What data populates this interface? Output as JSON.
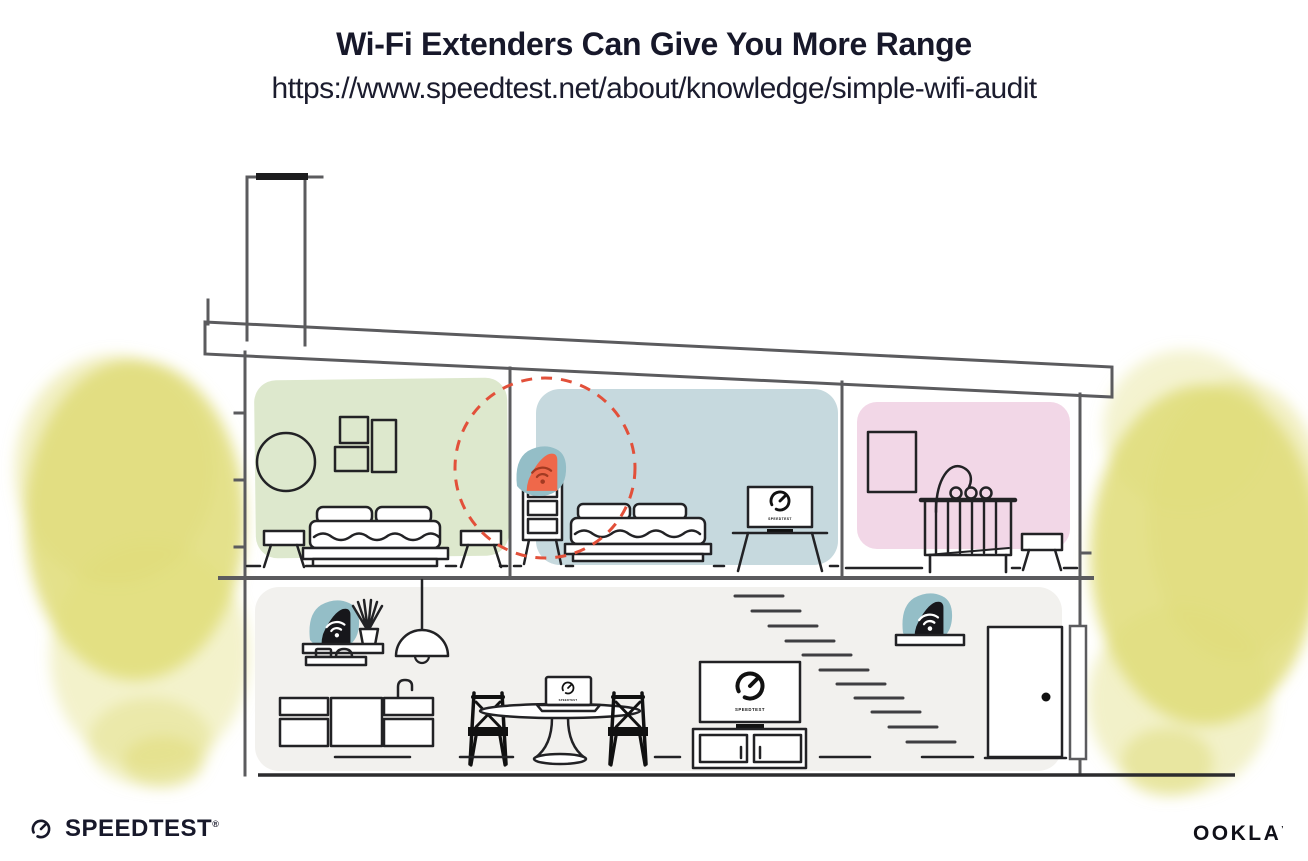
{
  "header": {
    "title": "Wi-Fi Extenders Can Give You More Range",
    "url": "https://www.speedtest.net/about/knowledge/simple-wifi-audit"
  },
  "illustration": {
    "description": "Cutaway side view of a two-story house: an orange Wi-Fi extender on a bedroom dresser has a dashed red coverage circle; black Wi-Fi routers sit on shelves on the main floor; TVs and a laptop display the Speedtest gauge.",
    "device_screen_label": "SPEEDTEST",
    "colors": {
      "room_green": "#dde8cd",
      "room_blue": "#c6d9de",
      "room_pink": "#f2d7e7",
      "floor_gray": "#f2f1ee",
      "foliage_yellow": "#dfdc77",
      "device_teal": "#94bec7",
      "device_black": "#17171b",
      "extender_orange": "#ef684a",
      "wifi_glyph_red": "#a23a22",
      "wifi_glyph_white": "#ffffff",
      "range_circle_red": "#e2503a"
    }
  },
  "footer": {
    "speedtest_wordmark": "SPEEDTEST",
    "speedtest_trademark": "®",
    "ookla_wordmark": "OOKLA",
    "ookla_trademark": "’"
  }
}
